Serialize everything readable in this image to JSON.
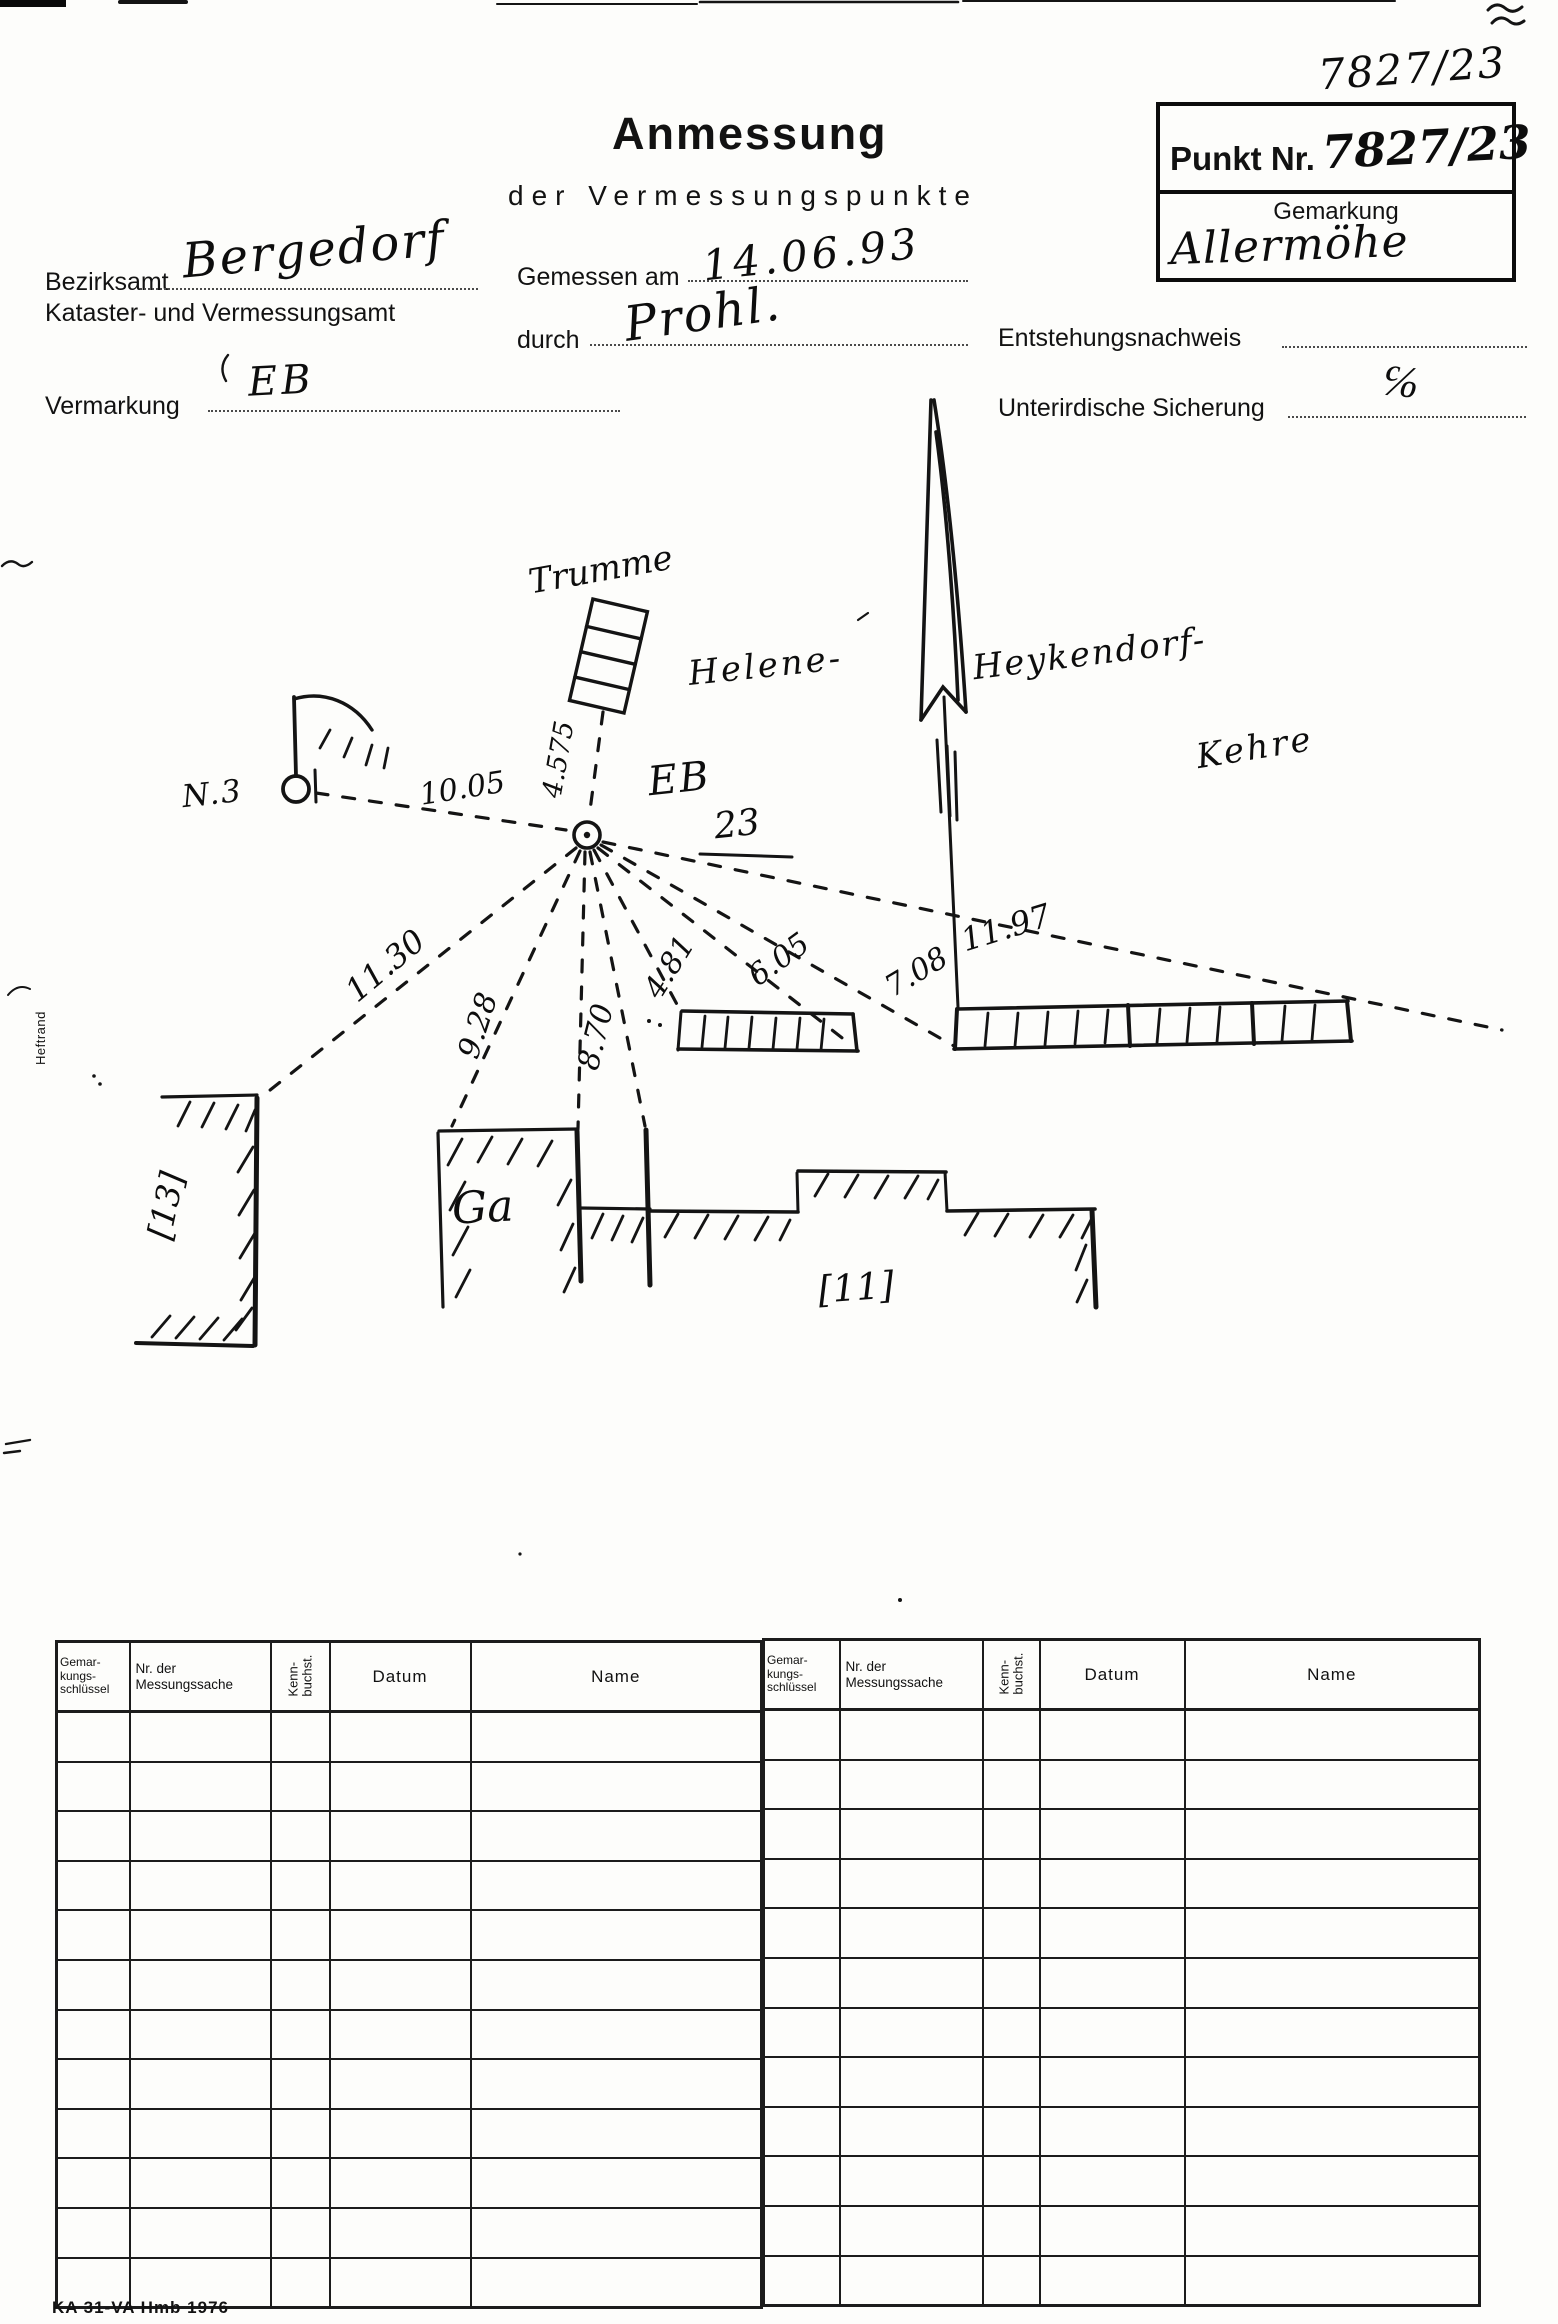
{
  "page": {
    "corner_number": "7827/23",
    "title": "Anmessung",
    "subtitle": "der Vermessungspunkte",
    "margin_label": "Heftrand",
    "footer": "KA 31-VA Hmb 1976"
  },
  "punkt_box": {
    "label": "Punkt Nr.",
    "number": "7827/23",
    "gemarkung_label": "Gemarkung",
    "gemarkung_value": "Allermöhe"
  },
  "fields": {
    "bezirksamt": {
      "label": "Bezirksamt",
      "value": "Bergedorf"
    },
    "kataster": {
      "label": "Kataster- und Vermessungsamt"
    },
    "gemessen_am": {
      "label": "Gemessen am",
      "value": "14.06.93"
    },
    "durch": {
      "label": "durch",
      "value": "Prohl."
    },
    "vermarkung": {
      "label": "Vermarkung",
      "value": "EB"
    },
    "entstehungsnachweis": {
      "label": "Entstehungsnachweis",
      "value": ""
    },
    "unterirdische_sicherung": {
      "label": "Unterirdische Sicherung",
      "value": "℅"
    }
  },
  "sketch": {
    "street": {
      "part1": "Helene-",
      "part2": "Heykendorf-",
      "part3": "Kehre"
    },
    "point": {
      "type": "EB",
      "number": "23"
    },
    "labels": {
      "lamp": "N.3",
      "drum": "Trumme",
      "garage": "Ga",
      "house_13": "[13]",
      "house_11": "[11]"
    },
    "measurements": {
      "to_lamp": "10.05",
      "to_drum": "4.575",
      "to_house13": "11.30",
      "to_garage_left": "9.28",
      "to_garage_right": "8.70",
      "to_fence1_left": "4.81",
      "to_fence1_right": "6.05",
      "to_fence2_left": "7.08",
      "to_fence2_right": "11.97"
    }
  },
  "table": {
    "headers": {
      "gemarkungsschluessel": "Gemar-\nkungs-\nschlüssel",
      "messungssache": "Nr. der\nMessungssache",
      "kennbuchstabe": "Kenn-\nbuchst.",
      "datum": "Datum",
      "name": "Name"
    },
    "row_count": 12
  }
}
